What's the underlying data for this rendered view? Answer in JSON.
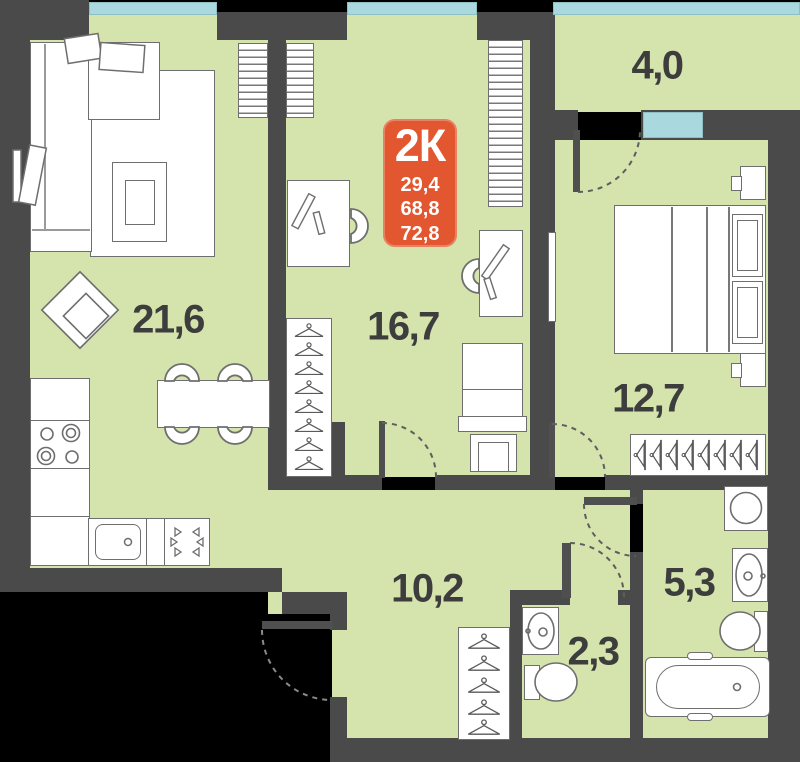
{
  "apartment_badge": {
    "type_label": "2К",
    "rooms_area": "29,4",
    "living_area": "68,8",
    "total_area": "72,8"
  },
  "rooms": {
    "living_kitchen": {
      "area": "21,6"
    },
    "room_children": {
      "area": "16,7"
    },
    "bedroom": {
      "area": "12,7"
    },
    "hallway": {
      "area": "10,2"
    },
    "bathroom": {
      "area": "5,3"
    },
    "wc": {
      "area": "2,3"
    },
    "balcony": {
      "area": "4,0"
    }
  },
  "colors": {
    "wall": "#4a4a4a",
    "floor": "#d5e3ad",
    "window": "#a9d8de",
    "badge": "#e2572f",
    "label_text": "#3d3d3d"
  }
}
